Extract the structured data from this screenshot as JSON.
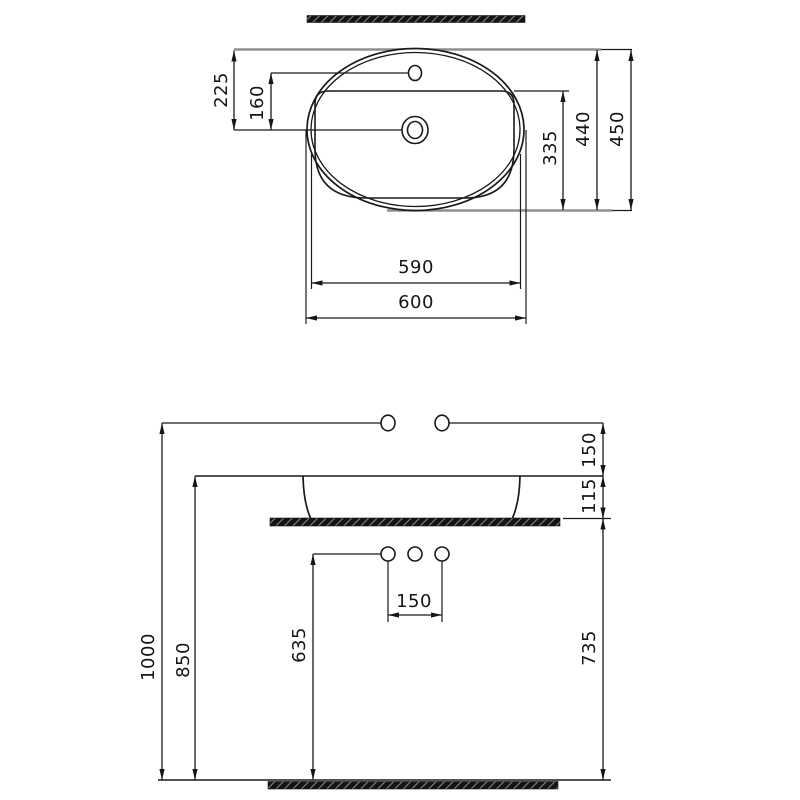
{
  "colors": {
    "line": "#1a1a1a",
    "extension_gray": "#8f8f8f",
    "hatch_fill": "#141414",
    "background": "#ffffff"
  },
  "top_view": {
    "dims": {
      "rim_front_to_drain": "225",
      "faucet_to_drain": "160",
      "bowl_depth": "335",
      "depth_inner": "440",
      "depth_overall": "450",
      "width_inner": "590",
      "width_overall": "600"
    }
  },
  "front_view": {
    "dims": {
      "faucet_above_rim": "150",
      "rim_above_counter": "115",
      "faucet_height": "1000",
      "rim_height": "850",
      "drain_line_height": "635",
      "hole_spacing": "150",
      "counter_top_height": "735"
    }
  }
}
